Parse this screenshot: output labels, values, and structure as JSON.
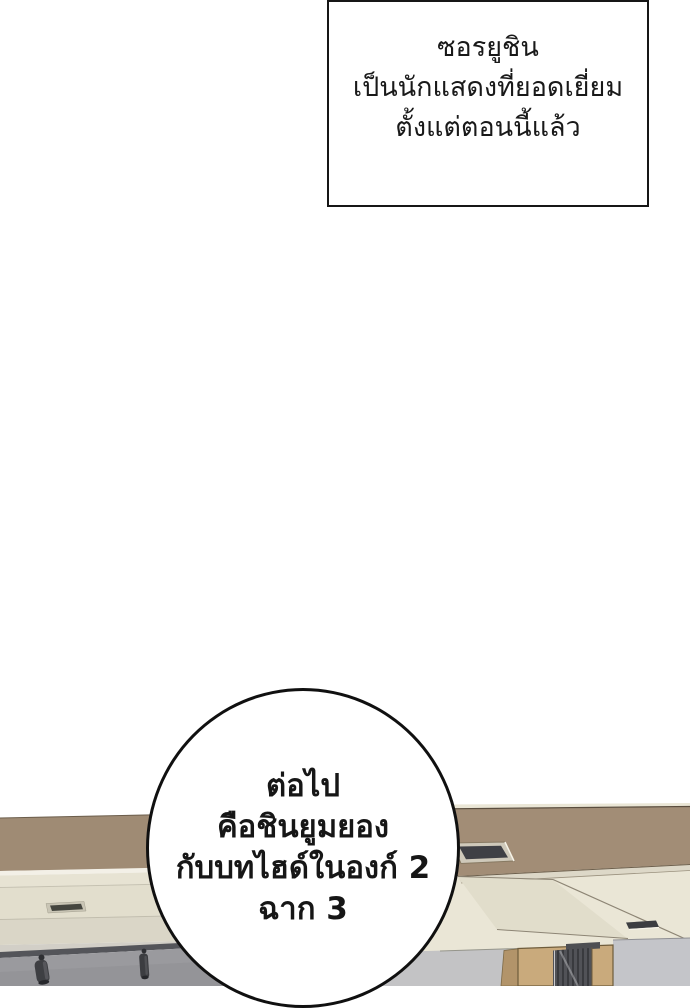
{
  "panel": {
    "narration_box": {
      "lines": [
        "ซอรยูชิน",
        "เป็นนักแสดงที่ยอดเยี่ยม",
        "ตั้งแต่ตอนนี้แล้ว"
      ]
    },
    "speech_bubble": {
      "lines": [
        "ต่อไป",
        "คือชินยูมยอง",
        "กับบทไฮด์ในองก์ 2",
        "ฉาก 3"
      ]
    },
    "colors": {
      "page_background": "#ffffff",
      "outline_black": "#161616",
      "ceiling_brown": "#a28d76",
      "ceiling_brown_left": "#9f8b74",
      "ceiling_cream": "#eae6d6",
      "cornice_highlight": "#f3f0e7",
      "cornice_band_a": "#e7e3d3",
      "cornice_band_b": "#e2decd",
      "cornice_band_c": "#dad6c7",
      "cornice_band_d": "#d2cfc7",
      "beam_face": "#e1ddcb",
      "fascia_cream": "#ddd8c8",
      "rail_dark": "#54555a",
      "wall_gray_left": "#9a9a9e",
      "wall_gray_mid": "#c3c3c5",
      "wall_gray_right": "#c4c5c9",
      "cabinet_wood": "#c9aa7c",
      "cabinet_wood_side": "#b2946a",
      "grille_dark": "#515257",
      "vent_dark": "#3f4045",
      "vent_frame": "#cfc9ba",
      "spotlight_body": "#3e3f43"
    }
  }
}
